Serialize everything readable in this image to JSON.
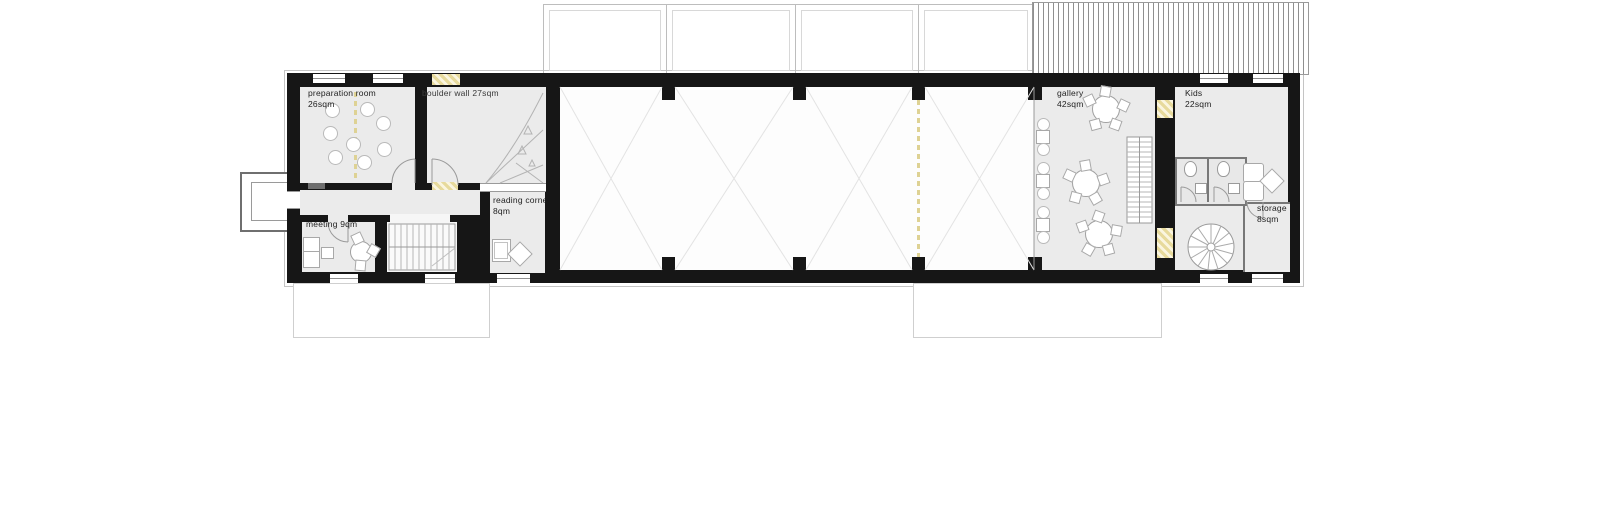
{
  "plan_title": "ground floor plan",
  "rooms": {
    "preparation": {
      "label": "preparation room",
      "area": "26sqm"
    },
    "boulder": {
      "label": "boulder wall 27sqm"
    },
    "reading": {
      "label": "reading corner",
      "area": "8qm"
    },
    "meeting": {
      "label": "meeting 9qm"
    },
    "gallery": {
      "label": "gallery",
      "area": "42sqm"
    },
    "kids": {
      "label": "Kids",
      "area": "22sqm"
    },
    "storage": {
      "label": "storage",
      "area": "8sqm"
    }
  },
  "colors": {
    "wall": "#161616",
    "room_fill": "#ebebeb",
    "hall_fill": "#fdfdfd",
    "accent_dash_yellow": "#ded294",
    "opening_hatch_yellow": "#e7da9c",
    "drawing_line": "#9a9a9a",
    "faint_line": "#c4c4c4"
  }
}
